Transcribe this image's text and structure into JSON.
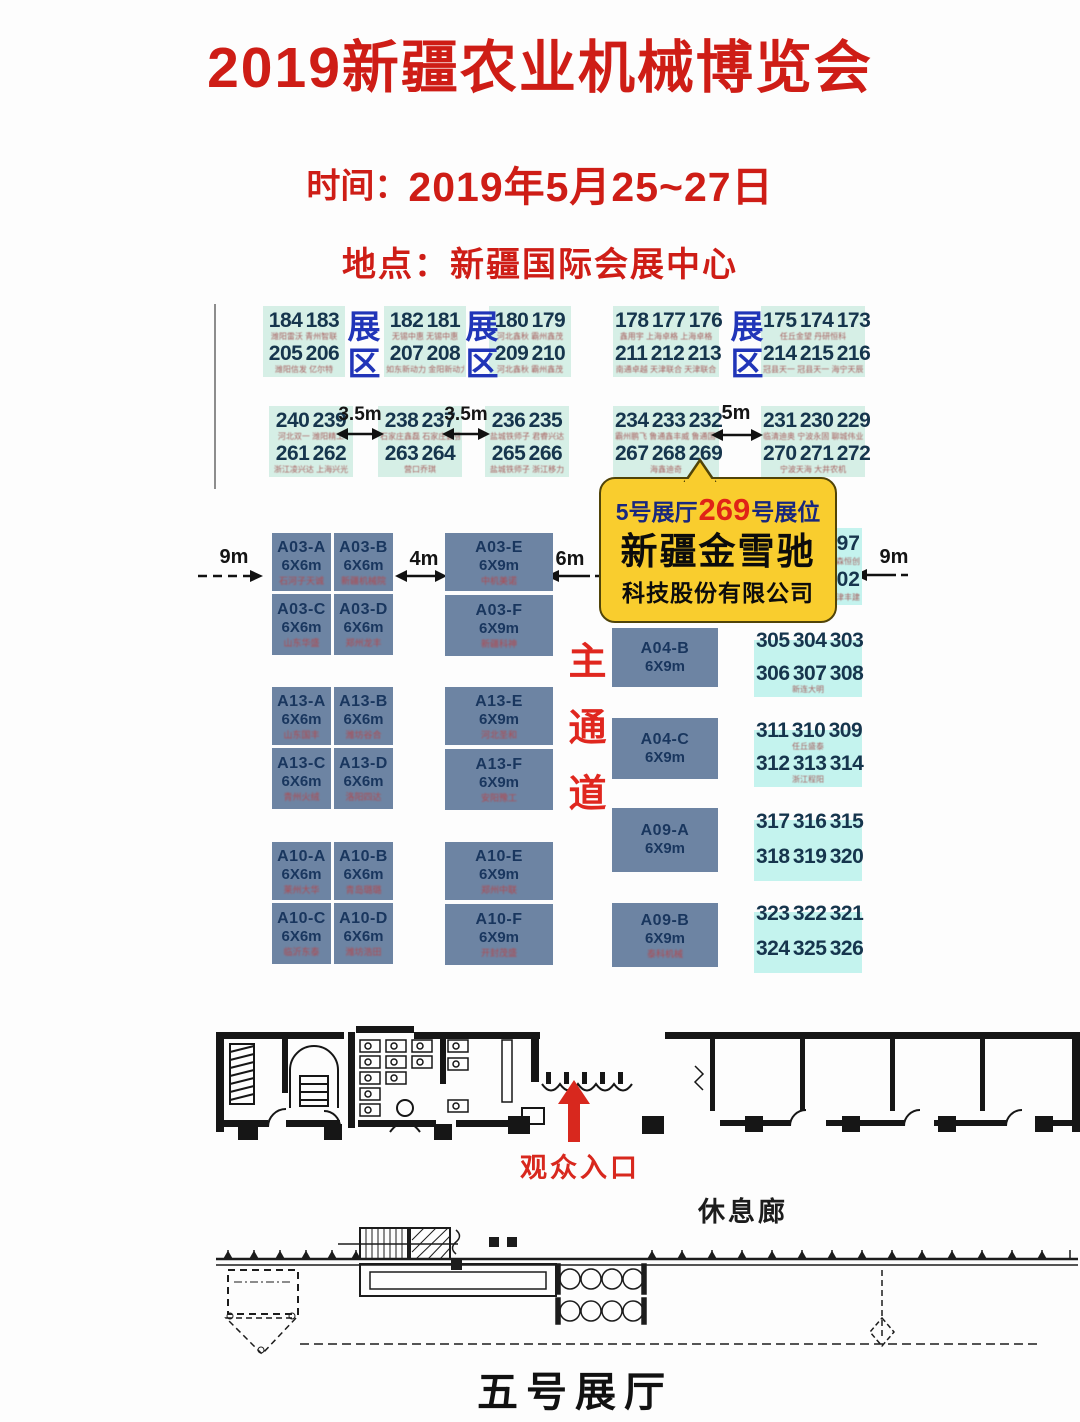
{
  "header": {
    "title": "2019新疆农业机械博览会",
    "time_label": "时间：",
    "time_value": "2019年5月25~27日",
    "venue_label": "地点：",
    "venue_value": "新疆国际会展中心"
  },
  "colors": {
    "title_red": "#ce1d16",
    "zone_blue": "#2135b8",
    "booth_slate": "#6d84a3",
    "block_cyan": "#c4f3ee",
    "block_mint": "#d6efe6",
    "callout_yellow": "#f9cd2e",
    "aisle_red": "#e0271f"
  },
  "map": {
    "zone_label": "展区",
    "main_aisle": "主通道",
    "dims": {
      "d9l": "9m",
      "d35a": "3.5m",
      "d35b": "3.5m",
      "d5": "5m",
      "d4": "4m",
      "d6": "6m",
      "d9r": "9m"
    },
    "number_groups": [
      {
        "id": "ta",
        "n1": "184 183",
        "c1": "潍阳雷沃 青州智联",
        "n2": "205 206",
        "c2": "潍阳信发 亿尔特"
      },
      {
        "id": "tb",
        "n1": "182 181",
        "c1": "无锡中惠 无锡中惠",
        "n2": "207 208",
        "c2": "如东新动力 金阳新动力"
      },
      {
        "id": "tc",
        "n1": "180 179",
        "c1": "河北鑫秋 霸州鑫茂",
        "n2": "209 210",
        "c2": "河北鑫秋 霸州鑫茂"
      },
      {
        "id": "td",
        "n1": "178 177 176",
        "c1": "鑫用宇 上海卓格 上海卓格",
        "n2": "211 212 213",
        "c2": "南通卓越 天津联合 天津联合"
      },
      {
        "id": "te",
        "n1": "175 174 173",
        "c1": "任丘金望 丹研恒科",
        "n2": "214 215 216",
        "c2": "冠县天一 冠县天一 海宁天辰"
      },
      {
        "id": "ra",
        "n1": "240 239",
        "c1": "河北双一 潍阳精工",
        "n2": "261 262",
        "c2": "浙江凌兴达 上海兴光"
      },
      {
        "id": "rb",
        "n1": "238 237",
        "c1": "石家庄鑫磊 石家庄鑫强",
        "n2": "263 264",
        "c2": "营口乔琪"
      },
      {
        "id": "rc",
        "n1": "236 235",
        "c1": "盐城铁师子 君睿兴达",
        "n2": "265 266",
        "c2": "盐城铁师子 浙江移力"
      },
      {
        "id": "rd",
        "n1": "234 233 232",
        "c1": "霸州鹏飞 鲁通鑫丰威 鲁通国丰威",
        "n2": "267 268 269",
        "c2": "海鑫迪奇"
      },
      {
        "id": "re",
        "n1": "231 230 229",
        "c1": "临清迪奥 宁波永固 聊城伟业",
        "n2": "270 271 272",
        "c2": "宁波天海 大井农机"
      },
      {
        "id": "297",
        "n1": "297",
        "c1": "鑫森恒创",
        "n2": "302",
        "c2": "大津丰建"
      },
      {
        "id": "305",
        "n1": "305 304 303",
        "c1": "",
        "n2": "306 307 308",
        "c2": "新连大明"
      },
      {
        "id": "311",
        "n1": "311 310 309",
        "c1": "任丘盛泰",
        "n2": "312 313 314",
        "c2": "浙江程阳"
      },
      {
        "id": "317",
        "n1": "317 316 315",
        "c1": "",
        "n2": "318 319 320",
        "c2": ""
      },
      {
        "id": "323",
        "n1": "323 322 321",
        "c1": "",
        "n2": "324 325 326",
        "c2": ""
      }
    ],
    "grids": {
      "a03": [
        {
          "name": "A03-A",
          "size": "6X6m",
          "cap": "石河子天诚"
        },
        {
          "name": "A03-B",
          "size": "6X6m",
          "cap": "新疆机械院"
        },
        {
          "name": "A03-C",
          "size": "6X6m",
          "cap": "山东华盛"
        },
        {
          "name": "A03-D",
          "size": "6X6m",
          "cap": "郑州龙丰"
        }
      ],
      "a13": [
        {
          "name": "A13-A",
          "size": "6X6m",
          "cap": "山东国丰"
        },
        {
          "name": "A13-B",
          "size": "6X6m",
          "cap": "潍坊谷合"
        },
        {
          "name": "A13-C",
          "size": "6X6m",
          "cap": "青州火绒"
        },
        {
          "name": "A13-D",
          "size": "6X6m",
          "cap": "洛阳四达"
        }
      ],
      "a10": [
        {
          "name": "A10-A",
          "size": "6X6m",
          "cap": "莱州大华"
        },
        {
          "name": "A10-B",
          "size": "6X6m",
          "cap": "青岛璐璐"
        },
        {
          "name": "A10-C",
          "size": "6X6m",
          "cap": "临沂东泰"
        },
        {
          "name": "A10-D",
          "size": "6X6m",
          "cap": "潍坊浩田"
        }
      ]
    },
    "cols": {
      "a03": [
        {
          "name": "A03-E",
          "size": "6X9m",
          "cap": "中机美诺"
        },
        {
          "name": "A03-F",
          "size": "6X9m",
          "cap": "新疆科神"
        }
      ],
      "a13": [
        {
          "name": "A13-E",
          "size": "6X9m",
          "cap": "河北圣和"
        },
        {
          "name": "A13-F",
          "size": "6X9m",
          "cap": "安阳豫工"
        }
      ],
      "a10": [
        {
          "name": "A10-E",
          "size": "6X9m",
          "cap": "郑州中联"
        },
        {
          "name": "A10-F",
          "size": "6X9m",
          "cap": "开封茂盛"
        }
      ]
    },
    "right_booths": [
      {
        "id": "a04b",
        "name": "A04-B",
        "size": "6X9m",
        "cap": ""
      },
      {
        "id": "a04c",
        "name": "A04-C",
        "size": "6X9m",
        "cap": ""
      },
      {
        "id": "a09a",
        "name": "A09-A",
        "size": "6X9m",
        "cap": ""
      },
      {
        "id": "a09b",
        "name": "A09-B",
        "size": "6X9m",
        "cap": "泰科机械"
      }
    ]
  },
  "callout": {
    "hall": "5号展厅",
    "booth_no": "269",
    "suffix": "号展位",
    "company": "新疆金雪驰",
    "company_suffix": "科技股份有限公司"
  },
  "plan": {
    "entrance_label": "观众入口",
    "rest_label": "休息廊",
    "hall_label": "五号展厅"
  }
}
